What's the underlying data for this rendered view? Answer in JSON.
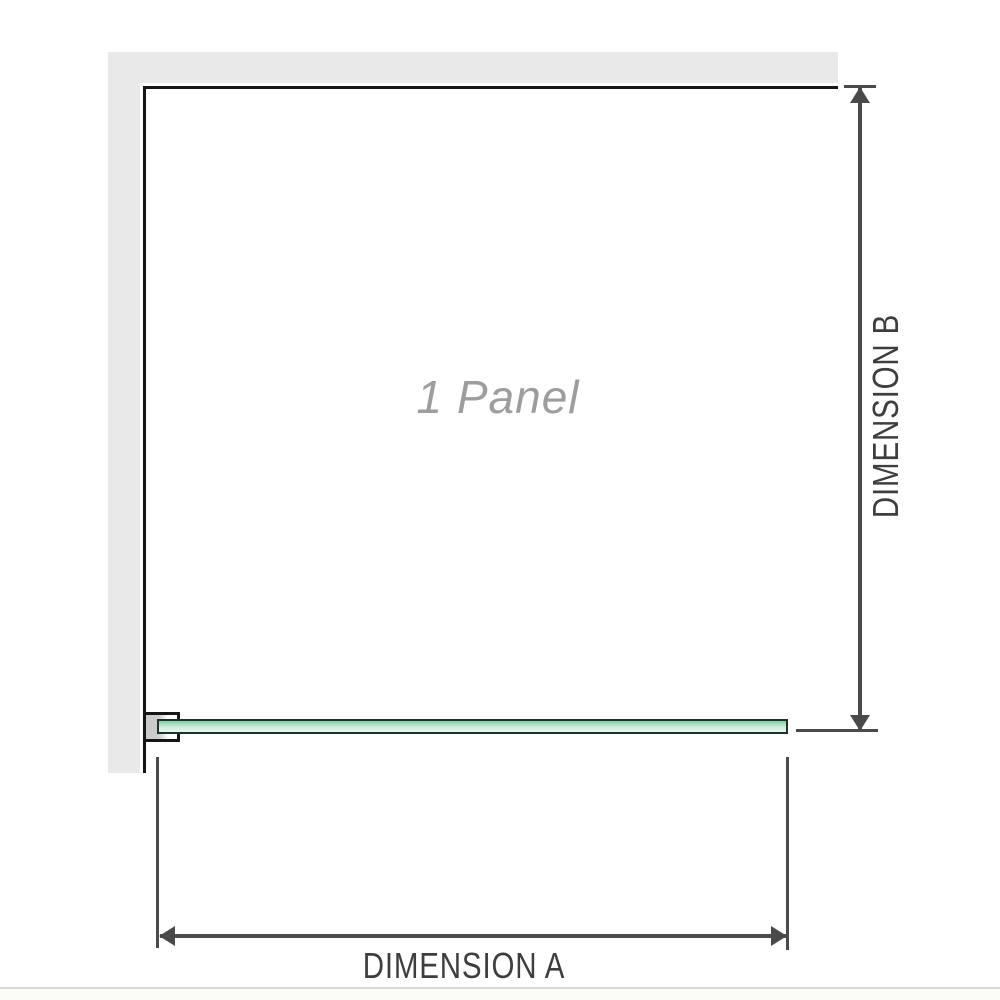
{
  "diagram": {
    "panel_label": "1 Panel"
  },
  "dimensions": {
    "a_label": "DIMENSION A",
    "b_label": "DIMENSION B"
  },
  "colors": {
    "wall_fill": "#e9e9e9",
    "wall_edge": "#161616",
    "glass_border": "#20302a",
    "glass_top": "#84cda2",
    "glass_mid": "#cdeedd",
    "glass_bottom": "#e4f6ec",
    "dimension_line": "#4a4a4a",
    "dimension_text": "#3e3e3e",
    "panel_text": "#9d9d9d",
    "bracket_fill": "#cbcbcb",
    "bottom_rule": "#d9d9d6",
    "below_strip": "#fbfbf8"
  }
}
